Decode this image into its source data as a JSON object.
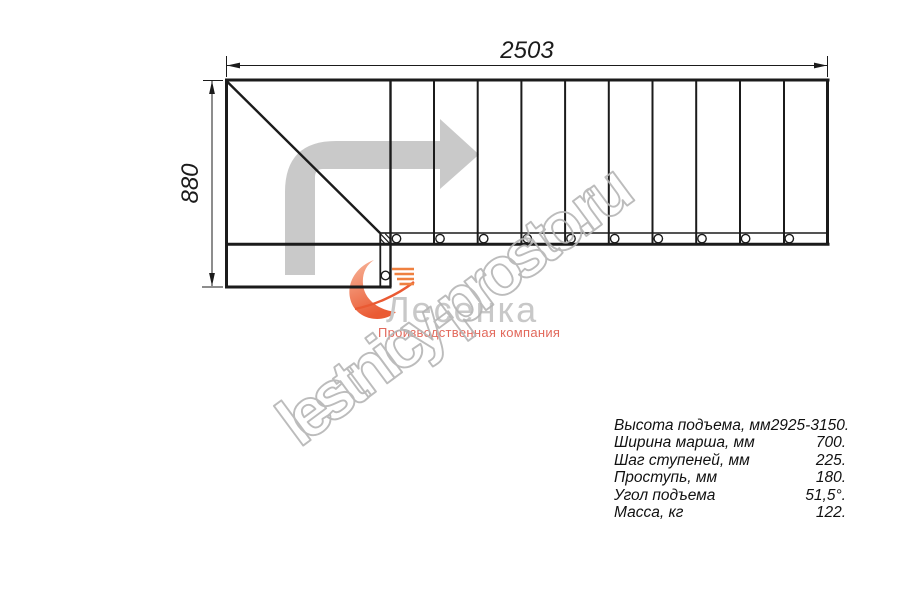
{
  "drawing": {
    "width_label": "2503",
    "height_label": "880"
  },
  "specs": [
    {
      "label": "Высота подъема, мм",
      "value": "2925-3150."
    },
    {
      "label": "Ширина марша, мм",
      "value": "700."
    },
    {
      "label": "Шаг ступеней, мм",
      "value": "225."
    },
    {
      "label": "Проступь, мм",
      "value": "180."
    },
    {
      "label": "Угол подъема",
      "value": "51,5°."
    },
    {
      "label": "Масса, кг",
      "value": "122."
    }
  ],
  "logo": {
    "brand": "Лесенка",
    "tagline": "Производственная компания"
  },
  "watermark": "lestnicy-prosto.ru",
  "colors": {
    "line": "#1b1b1b",
    "direction_arrow": "#c9c9c9",
    "logo_text": "#c8c8c8",
    "logo_accent_orange": "#ee6a3c",
    "tagline_red": "#e2695c",
    "watermark_outline": "#b5b5b5"
  }
}
